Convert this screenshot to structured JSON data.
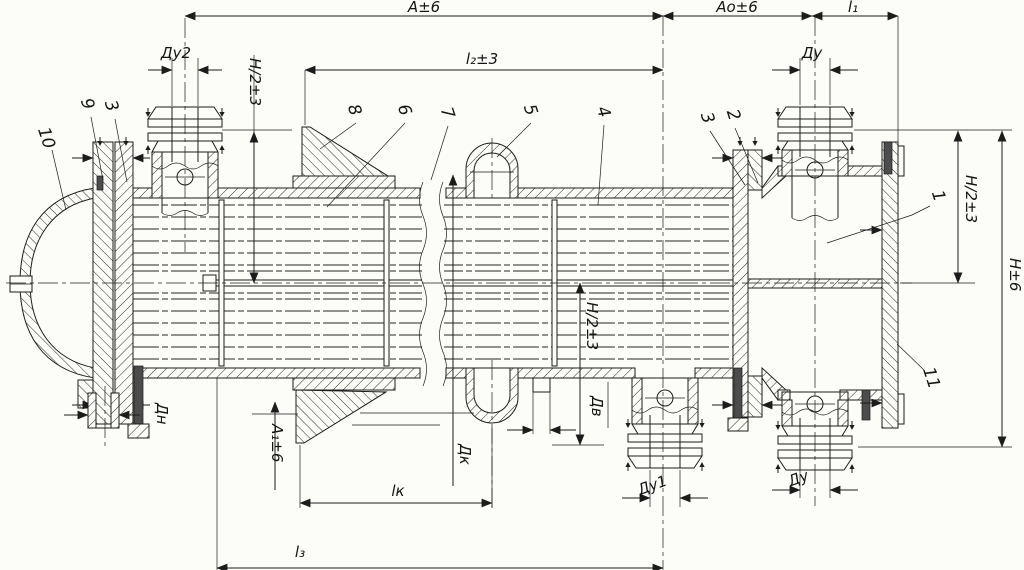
{
  "colors": {
    "ink": "#1c1c1c",
    "paper": "#fcfcf9"
  },
  "dimensions": {
    "a": "А±6",
    "ao": "Ао±6",
    "l1": "l₁",
    "l2": "l₂±3",
    "l3": "l₃",
    "lk": "lк",
    "a1": "А₁±6",
    "h": "Н±6",
    "h2_left": "Н/2±3",
    "h2_mid": "Н/2±3",
    "h2_right": "Н/2±3",
    "du2": "Ду2",
    "du_top_right": "Ду",
    "du1": "Ду1",
    "du_bottom_right": "Ду",
    "dn": "Дн",
    "dk": "Дк",
    "dv": "Дв"
  },
  "parts": {
    "n1": "1",
    "n2": "2",
    "n3_right": "3",
    "n3_left": "3",
    "n4": "4",
    "n5": "5",
    "n6": "6",
    "n7": "7",
    "n8": "8",
    "n9": "9",
    "n10": "10",
    "n11": "11"
  }
}
